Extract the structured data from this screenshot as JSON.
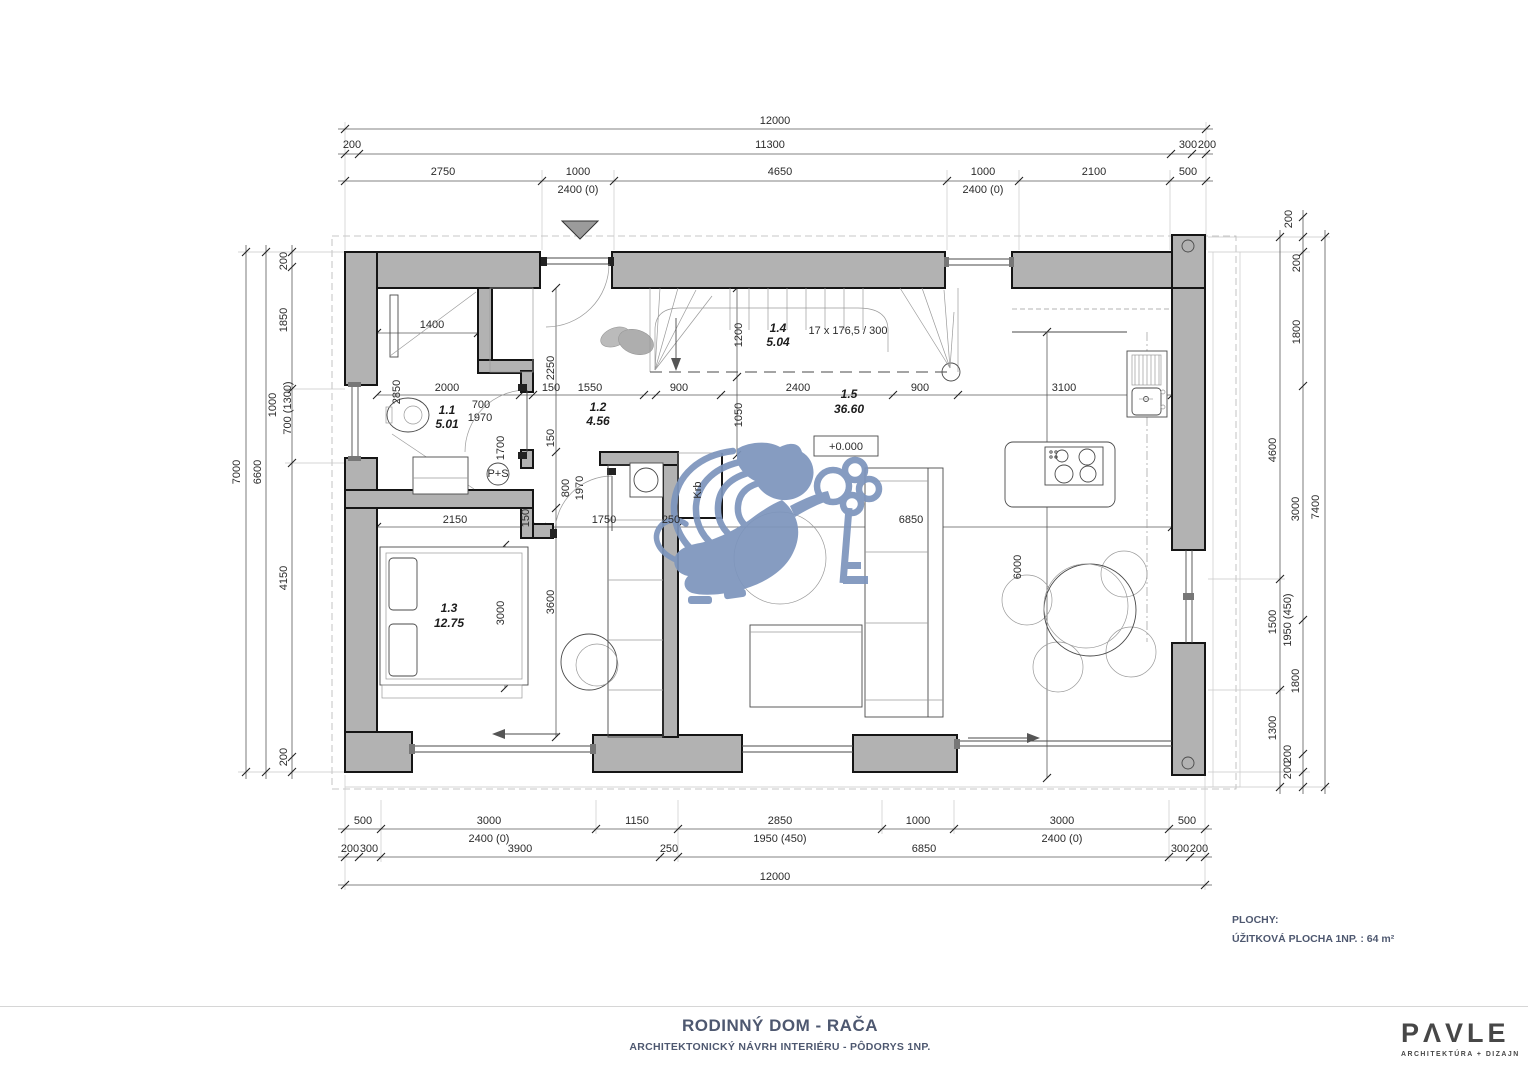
{
  "title_block": {
    "title": "RODINNÝ DOM - RAČA",
    "subtitle": "ARCHITEKTONICKÝ NÁVRH INTERIÉRU - PÔDORYS 1NP."
  },
  "logo": {
    "name": "PΛVLE",
    "tagline": "ARCHITEKTÚRA + DIZAJN"
  },
  "areas": {
    "heading": "PLOCHY:",
    "line": "ÚŽITKOVÁ PLOCHA 1NP. : 64 m²"
  },
  "colors": {
    "wall_gray": "#b2b2b2",
    "watermark_blue": "#7d95bd",
    "accent_text": "#4e5870"
  },
  "plan": {
    "rooms": [
      {
        "id": "1.1",
        "area": "5.01"
      },
      {
        "id": "1.2",
        "area": "4.56"
      },
      {
        "id": "1.3",
        "area": "12.75"
      },
      {
        "id": "1.4",
        "area": "5.04"
      },
      {
        "id": "1.5",
        "area": "36.60"
      }
    ],
    "stair_note": "17 x 176,5 / 300",
    "level_mark": "+0.000",
    "labels": [
      {
        "t": "12000",
        "x": 775,
        "y": 124
      },
      {
        "t": "200",
        "x": 352,
        "y": 148
      },
      {
        "t": "11300",
        "x": 770,
        "y": 148
      },
      {
        "t": "300",
        "x": 1188,
        "y": 148
      },
      {
        "t": "200",
        "x": 1207,
        "y": 148
      },
      {
        "t": "2750",
        "x": 443,
        "y": 175
      },
      {
        "t": "1000",
        "x": 578,
        "y": 175
      },
      {
        "t": "2400 (0)",
        "x": 578,
        "y": 193
      },
      {
        "t": "4650",
        "x": 780,
        "y": 175
      },
      {
        "t": "1000",
        "x": 983,
        "y": 175
      },
      {
        "t": "2400 (0)",
        "x": 983,
        "y": 193
      },
      {
        "t": "2100",
        "x": 1094,
        "y": 175
      },
      {
        "t": "500",
        "x": 1188,
        "y": 175
      },
      {
        "t": "500",
        "x": 363,
        "y": 824
      },
      {
        "t": "3000",
        "x": 489,
        "y": 824
      },
      {
        "t": "2400 (0)",
        "x": 489,
        "y": 842
      },
      {
        "t": "1150",
        "x": 637,
        "y": 824
      },
      {
        "t": "2850",
        "x": 780,
        "y": 824
      },
      {
        "t": "1950 (450)",
        "x": 780,
        "y": 842
      },
      {
        "t": "1000",
        "x": 918,
        "y": 824
      },
      {
        "t": "3000",
        "x": 1062,
        "y": 824
      },
      {
        "t": "2400 (0)",
        "x": 1062,
        "y": 842
      },
      {
        "t": "500",
        "x": 1187,
        "y": 824
      },
      {
        "t": "200",
        "x": 350,
        "y": 852
      },
      {
        "t": "300",
        "x": 369,
        "y": 852
      },
      {
        "t": "3900",
        "x": 520,
        "y": 852
      },
      {
        "t": "250",
        "x": 669,
        "y": 852
      },
      {
        "t": "6850",
        "x": 924,
        "y": 852
      },
      {
        "t": "300",
        "x": 1180,
        "y": 852
      },
      {
        "t": "200",
        "x": 1199,
        "y": 852
      },
      {
        "t": "12000",
        "x": 775,
        "y": 880
      },
      {
        "t": "7000",
        "x": 240,
        "y": 472,
        "r": 1
      },
      {
        "t": "6600",
        "x": 261,
        "y": 472,
        "r": 1
      },
      {
        "t": "200",
        "x": 287,
        "y": 261,
        "r": 1
      },
      {
        "t": "1850",
        "x": 287,
        "y": 320,
        "r": 1
      },
      {
        "t": "1000",
        "x": 276,
        "y": 405,
        "r": 1
      },
      {
        "t": "700 (1300)",
        "x": 291,
        "y": 408,
        "r": 1
      },
      {
        "t": "4150",
        "x": 287,
        "y": 578,
        "r": 1
      },
      {
        "t": "200",
        "x": 287,
        "y": 757,
        "r": 1
      },
      {
        "t": "200",
        "x": 1292,
        "y": 219,
        "r": 1
      },
      {
        "t": "200",
        "x": 1300,
        "y": 263,
        "r": 1
      },
      {
        "t": "1800",
        "x": 1300,
        "y": 332,
        "r": 1
      },
      {
        "t": "4600",
        "x": 1276,
        "y": 450,
        "r": 1
      },
      {
        "t": "3000",
        "x": 1299,
        "y": 509,
        "r": 1
      },
      {
        "t": "7400",
        "x": 1319,
        "y": 507,
        "r": 1
      },
      {
        "t": "1500",
        "x": 1276,
        "y": 622,
        "r": 1
      },
      {
        "t": "1950 (450)",
        "x": 1291,
        "y": 620,
        "r": 1
      },
      {
        "t": "1800",
        "x": 1299,
        "y": 681,
        "r": 1
      },
      {
        "t": "1300",
        "x": 1276,
        "y": 728,
        "r": 1
      },
      {
        "t": "200",
        "x": 1291,
        "y": 754,
        "r": 1
      },
      {
        "t": "200",
        "x": 1291,
        "y": 770,
        "r": 1
      },
      {
        "t": "1400",
        "x": 432,
        "y": 328
      },
      {
        "t": "2850",
        "x": 400,
        "y": 392,
        "r": 1
      },
      {
        "t": "2000",
        "x": 447,
        "y": 391
      },
      {
        "t": "700",
        "x": 481,
        "y": 408
      },
      {
        "t": "1970",
        "x": 480,
        "y": 421
      },
      {
        "t": "1700",
        "x": 504,
        "y": 448,
        "r": 1
      },
      {
        "t": "2250",
        "x": 554,
        "y": 368,
        "r": 1
      },
      {
        "t": "150",
        "x": 554,
        "y": 438,
        "r": 1
      },
      {
        "t": "150",
        "x": 551,
        "y": 391
      },
      {
        "t": "1550",
        "x": 590,
        "y": 391
      },
      {
        "t": "900",
        "x": 679,
        "y": 391
      },
      {
        "t": "2400",
        "x": 798,
        "y": 391
      },
      {
        "t": "900",
        "x": 920,
        "y": 391
      },
      {
        "t": "3100",
        "x": 1064,
        "y": 391
      },
      {
        "t": "1200",
        "x": 742,
        "y": 335,
        "r": 1
      },
      {
        "t": "1050",
        "x": 742,
        "y": 415,
        "r": 1
      },
      {
        "t": "800",
        "x": 569,
        "y": 488,
        "r": 1
      },
      {
        "t": "1970",
        "x": 583,
        "y": 488,
        "r": 1
      },
      {
        "t": "2150",
        "x": 455,
        "y": 523
      },
      {
        "t": "150",
        "x": 529,
        "y": 518,
        "r": 1
      },
      {
        "t": "1750",
        "x": 604,
        "y": 523
      },
      {
        "t": "250",
        "x": 671,
        "y": 523
      },
      {
        "t": "3000",
        "x": 504,
        "y": 613,
        "r": 1
      },
      {
        "t": "3600",
        "x": 554,
        "y": 602,
        "r": 1
      },
      {
        "t": "6850",
        "x": 911,
        "y": 523
      },
      {
        "t": "6000",
        "x": 1021,
        "y": 567,
        "r": 1
      },
      {
        "t": "17 x 176,5 / 300",
        "x": 848,
        "y": 334,
        "fs": 11.5
      },
      {
        "t": "1.1",
        "x": 447,
        "y": 414,
        "b": 1,
        "n": "room-label"
      },
      {
        "t": "5.01",
        "x": 447,
        "y": 428,
        "b": 1,
        "n": "room-area"
      },
      {
        "t": "1.2",
        "x": 598,
        "y": 411,
        "b": 1,
        "n": "room-label"
      },
      {
        "t": "4.56",
        "x": 598,
        "y": 425,
        "b": 1,
        "n": "room-area"
      },
      {
        "t": "1.3",
        "x": 449,
        "y": 612,
        "b": 1,
        "n": "room-label"
      },
      {
        "t": "12.75",
        "x": 449,
        "y": 627,
        "b": 1,
        "n": "room-area"
      },
      {
        "t": "1.4",
        "x": 778,
        "y": 332,
        "b": 1,
        "n": "room-label"
      },
      {
        "t": "5.04",
        "x": 778,
        "y": 346,
        "b": 1,
        "n": "room-area"
      },
      {
        "t": "1.5",
        "x": 849,
        "y": 398,
        "b": 1,
        "n": "room-label"
      },
      {
        "t": "36.60",
        "x": 849,
        "y": 413,
        "b": 1,
        "n": "room-area"
      },
      {
        "t": "+0.000",
        "x": 846,
        "y": 450,
        "fs": 13,
        "n": "level-mark"
      },
      {
        "t": "Krb",
        "x": 701,
        "y": 490,
        "r": 1,
        "fs": 10,
        "n": "fireplace-label"
      },
      {
        "t": "P+S",
        "x": 498,
        "y": 477,
        "fs": 7,
        "n": "washer-dryer-label"
      }
    ]
  }
}
